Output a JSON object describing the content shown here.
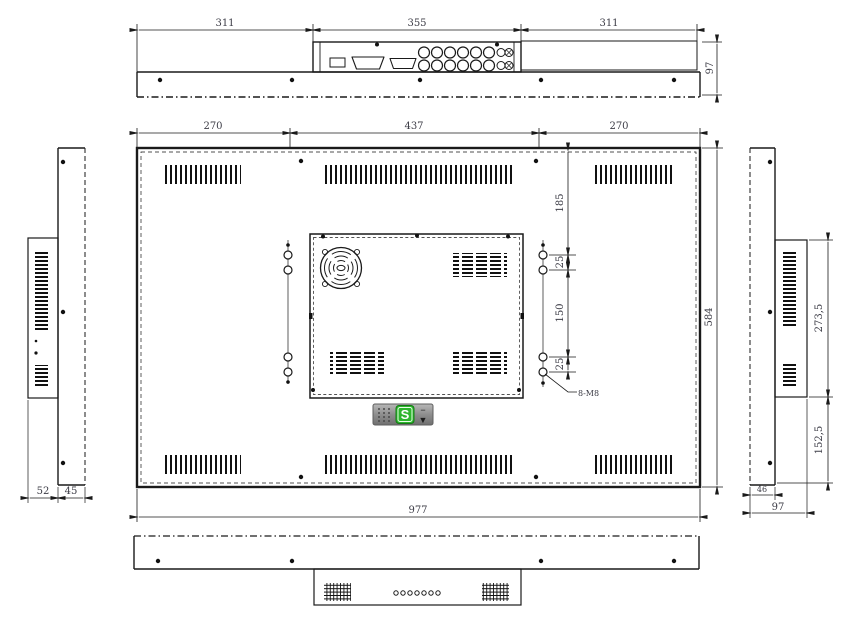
{
  "drawing_title": "display-rear-panel-technical-drawing",
  "colors": {
    "line": "#1a1a1a",
    "dim_text": "#3c3c46",
    "background": "#ffffff",
    "widget_green": "#2db52d",
    "widget_gray": "#8a8a8a"
  },
  "top_view": {
    "dim_left": "311",
    "dim_center": "355",
    "dim_right": "311",
    "dim_depth": "97"
  },
  "main_view": {
    "dim_top_left": "270",
    "dim_top_center": "437",
    "dim_top_right": "270",
    "dim_hole_offset": "185",
    "dim_hole_gap_top": "25",
    "dim_hole_span": "150",
    "dim_hole_gap_bottom": "25",
    "hole_callout": "8-M8",
    "dim_height": "584",
    "dim_width": "977"
  },
  "left_view": {
    "dim_front": "52",
    "dim_back": "45"
  },
  "right_view": {
    "dim_upper": "273,5",
    "dim_lower": "152,5",
    "dim_back": "46",
    "dim_depth": "97"
  },
  "widget": {
    "logo": "S",
    "minimize": "−",
    "expand": "▼"
  }
}
